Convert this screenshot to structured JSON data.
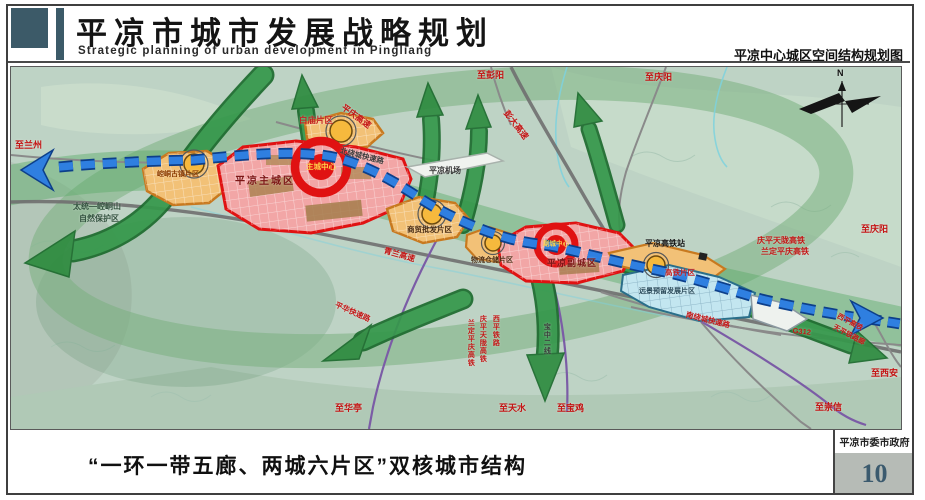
{
  "header": {
    "title": "平凉市城市发展战略规划",
    "subtitle": "Strategic planning of urban development in Pingliang",
    "right_caption": "平凉中心城区空间结构规划图"
  },
  "footer": {
    "caption": "“一环一带五廊、两城六片区”双核城市结构",
    "agency": "平凉市委市政府",
    "page_number": "10"
  },
  "map": {
    "compass": "N",
    "labels": {
      "to_lanzhou": "至兰州",
      "to_pengyang": "至彭阳",
      "to_qingyang_top": "至庆阳",
      "to_qingyang_right": "至庆阳",
      "pengda_expwy": "彭大高速",
      "pingqing_expwy": "平庆高速",
      "north_ring_road": "北绕城快速路",
      "baimiao_district": "白庙片区",
      "airport": "平凉机场",
      "main_city": "平凉主城区",
      "main_center": "主城中心",
      "kongtong_district": "崆峒古镇片区",
      "nature_reserve_line1": "太统—崆峒山",
      "nature_reserve_line2": "自然保护区",
      "qinglan_expwy": "青兰高速",
      "trade_district": "商贸批发片区",
      "logistics_district": "物流仓储片区",
      "sub_center": "副城中心",
      "sub_city": "平凉副城区",
      "hsr_station": "平凉高铁站",
      "hsr_district": "高铁片区",
      "reserved_district": "远景预留发展片区",
      "qingpingtianlong_hsr": "庆平天陇高铁",
      "landingpingqing_hsr": "兰定平庆高铁",
      "south_ring_road": "南绕城快速路",
      "g312": "G312",
      "pinghua_expwy": "平华快速路",
      "xiping_hsr": "西平高铁",
      "tianping_rail": "天平铁路廊",
      "to_xian": "至西安",
      "to_chongxin": "至崇信",
      "to_baoji": "至宝鸡",
      "to_tianshui": "至天水",
      "to_huating": "至华亭",
      "landingpingqing_hsr_v": "兰定平庆高铁",
      "qingpingtianlong_hsr_v": "庆平天陇高铁",
      "xiping_rail_v": "西平铁路",
      "baozhong_line_v": "宝中二线"
    },
    "colors": {
      "road_text_red": "#c41414",
      "corridor_green": "#2e8b3f",
      "axis_blue": "#2f7fe0",
      "core_red": "#e01212",
      "zone_orange": "#f2c177",
      "zone_pink": "#f2a6a6",
      "zone_lightblue": "#c3e6f0",
      "header_slate": "#3c5a68"
    }
  }
}
